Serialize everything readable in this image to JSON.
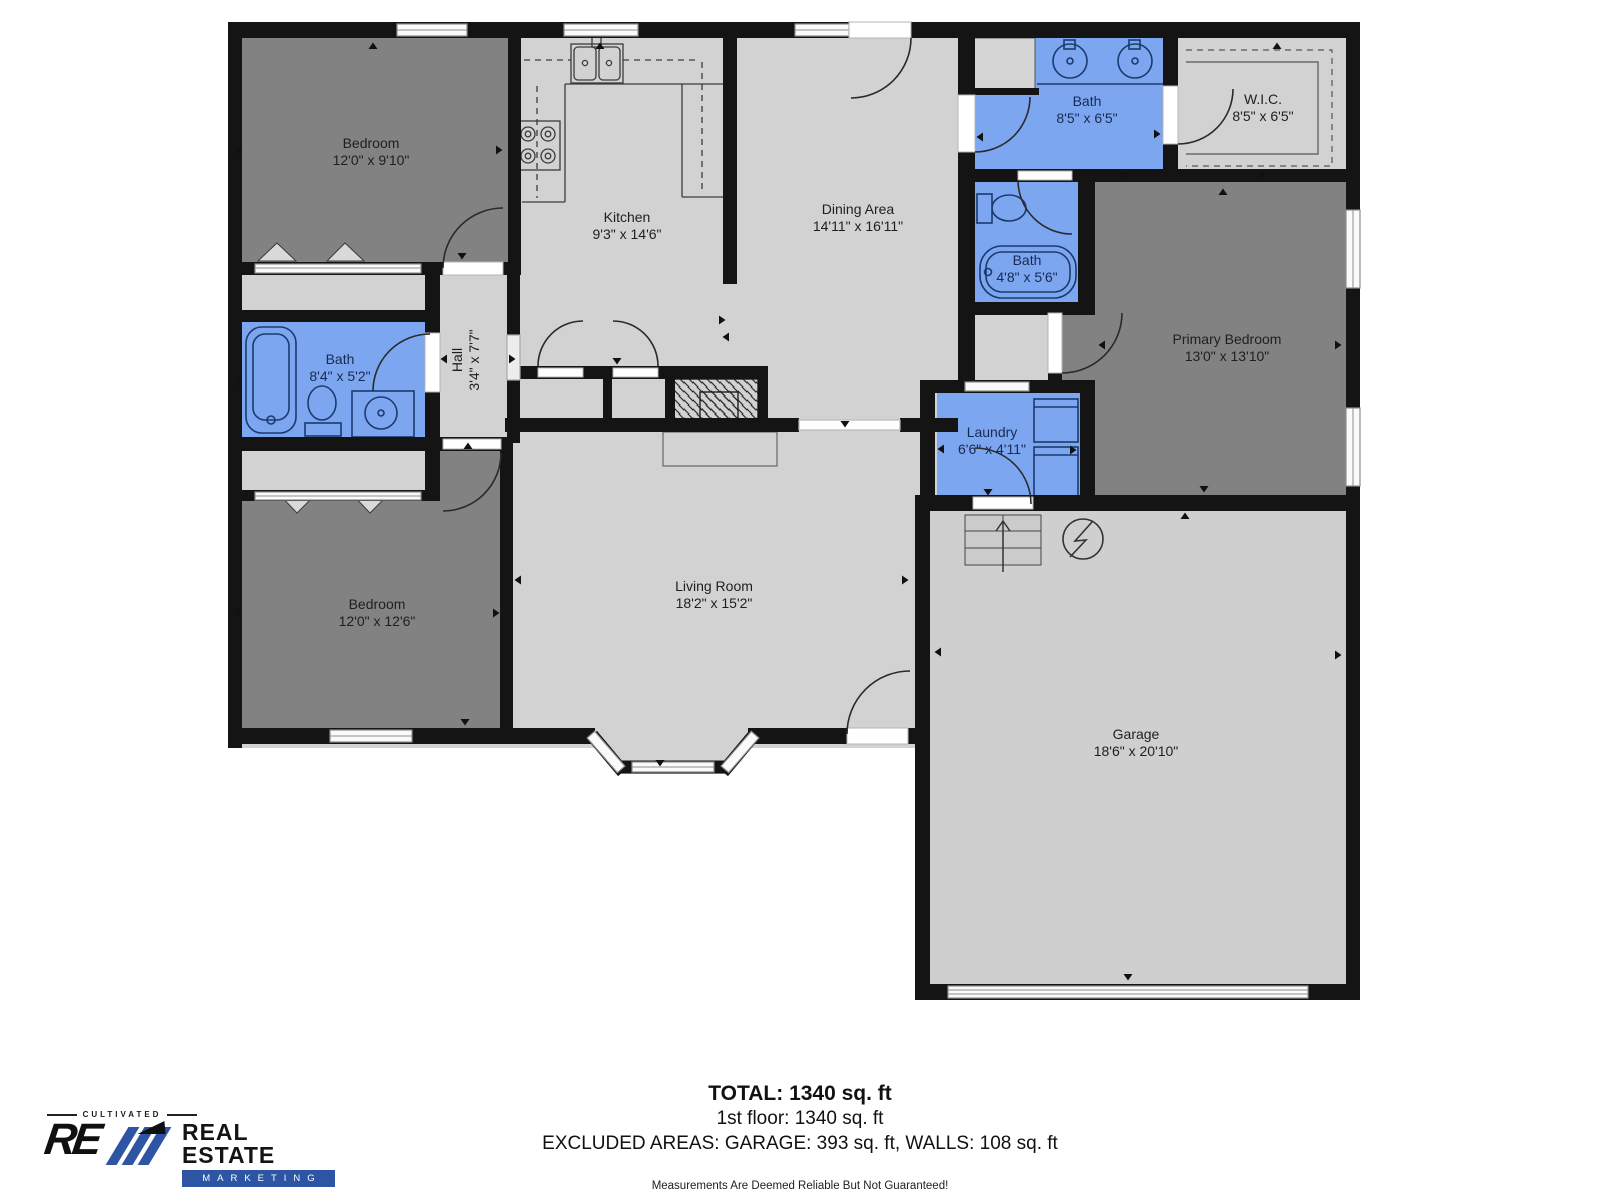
{
  "plan": {
    "rooms": [
      {
        "name": "Bedroom",
        "dims": "12'0\" x 9'10\""
      },
      {
        "name": "Kitchen",
        "dims": "9'3\" x 14'6\""
      },
      {
        "name": "Dining Area",
        "dims": "14'11\" x 16'11\""
      },
      {
        "name": "Bath",
        "dims": "8'5\" x 6'5\""
      },
      {
        "name": "W.I.C.",
        "dims": "8'5\" x 6'5\""
      },
      {
        "name": "Bath",
        "dims": "4'8\" x 5'6\""
      },
      {
        "name": "Primary Bedroom",
        "dims": "13'0\" x 13'10\""
      },
      {
        "name": "Bath",
        "dims": "8'4\" x 5'2\""
      },
      {
        "name": "Hall",
        "dims": "3'4\" x 7'7\""
      },
      {
        "name": "Laundry",
        "dims": "6'6\" x 4'11\""
      },
      {
        "name": "Bedroom",
        "dims": "12'0\" x 12'6\""
      },
      {
        "name": "Living Room",
        "dims": "18'2\" x 15'2\""
      },
      {
        "name": "Garage",
        "dims": "18'6\" x 20'10\""
      }
    ]
  },
  "summary": {
    "total": "TOTAL: 1340 sq. ft",
    "floor": "1st floor: 1340 sq. ft",
    "excluded": "EXCLUDED AREAS: GARAGE: 393 sq. ft, WALLS: 108 sq. ft",
    "disclaimer": "Measurements Are Deemed Reliable But Not Guaranteed!"
  },
  "logo": {
    "tagline": "CULTIVATED",
    "mark": "RE",
    "title": "REAL ESTATE",
    "subtitle": "MARKETING"
  },
  "colors": {
    "wall": "#141414",
    "floor": "#d2d2d2",
    "bedroom": "#828282",
    "bath_blue": "#7da6f0",
    "fixture_stroke": "#1c3a6e",
    "logo_blue": "#2d55a3"
  }
}
